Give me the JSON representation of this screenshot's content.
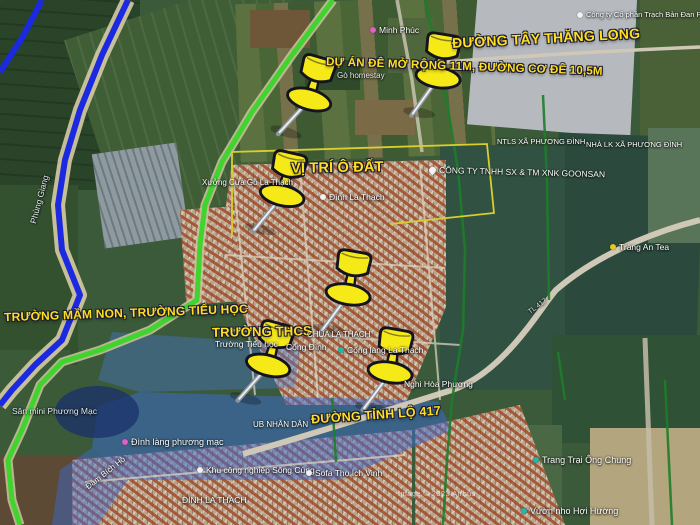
{
  "image_type": "annotated satellite map screenshot",
  "annotations": [
    {
      "text": "ĐƯỜNG TÂY THĂNG LONG"
    },
    {
      "text": "DỰ ÁN ĐÊ MỞ RỘNG 11M, ĐƯỜNG CƠ ĐÊ 10,5M"
    },
    {
      "text": "VỊ TRÍ Ô ĐẤT"
    },
    {
      "text": "TRƯỜNG MẦM NON, TRƯỜNG TIỂU HỌC"
    },
    {
      "text": "TRƯỜNG THCS"
    },
    {
      "text": "ĐƯỜNG TỈNH LỘ 417"
    }
  ],
  "pois": [
    {
      "text": "Minh Phúc"
    },
    {
      "text": "Công ty Cổ phần Trạch Bản Đan Ph"
    },
    {
      "text": "Gò homestay"
    },
    {
      "text": "NTLS XÃ PHƯƠNG ĐÌNH"
    },
    {
      "text": "NHÀ LK XÃ PHƯƠNG ĐÌNH"
    },
    {
      "text": "Xưởng Cưa Gỗ La Thạch"
    },
    {
      "text": "CÔNG TY TNHH SX & TM XNK GOONSAN"
    },
    {
      "text": "Đình La Thạch"
    },
    {
      "text": "Tràng An Tea"
    },
    {
      "text": "CHÙA LA THẠCH"
    },
    {
      "text": "Trường Tiểu học"
    },
    {
      "text": "Cổng Đình"
    },
    {
      "text": "Cống làng La Thạch"
    },
    {
      "text": "Nghi Hòa Phương"
    },
    {
      "text": "Sân mini Phương Mạc"
    },
    {
      "text": "Đình làng phương mạc"
    },
    {
      "text": "UB NHÂN DÂN"
    },
    {
      "text": "Đầm Bích Hồ"
    },
    {
      "text": "Khu công nghiệp Sông Cùng"
    },
    {
      "text": "Sofa Thọ Ích Vinh"
    },
    {
      "text": "ĐÌNH LA THẠCH"
    },
    {
      "text": "Trang Trại Ông Chung"
    },
    {
      "text": "Vườn nho Hợi Hường"
    },
    {
      "text": "Phùng Giang"
    },
    {
      "text": "TL 417"
    }
  ],
  "credit": "Image © 2023 Airbus",
  "pushpins": {
    "count": 6,
    "color": "#f6e918"
  },
  "colors": {
    "annotation_yellow": "#ffdf1e",
    "route_blue": "#1b2ae0",
    "route_green": "#3fd42e",
    "road_green_dark": "#1e7d2a",
    "plot_boundary_yellow": "#d8ce2e",
    "highlight_blue": "rgba(58,108,212,0.5)"
  }
}
